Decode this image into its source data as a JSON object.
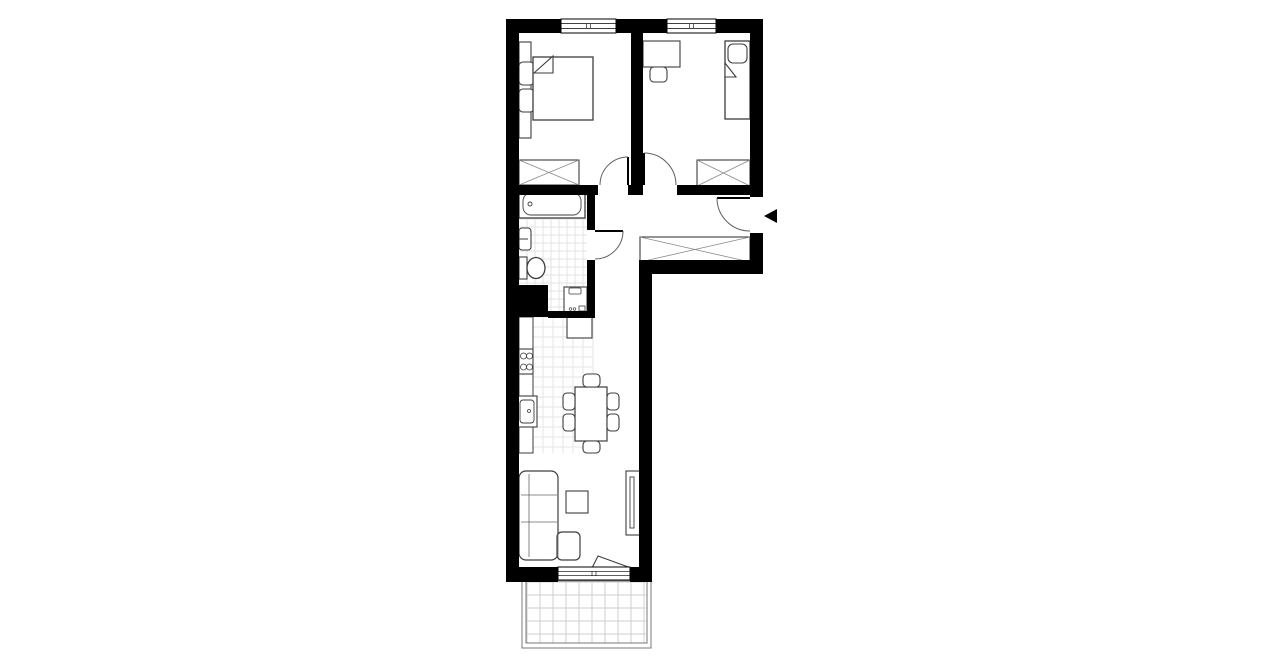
{
  "canvas": {
    "width": 1280,
    "height": 667,
    "background": "#ffffff"
  },
  "colors": {
    "wall": "#000000",
    "line": "#3d3d3d",
    "thin": "#666666",
    "tile_bath": "#e3e3e3",
    "tile_kitchen": "#e6e6e6",
    "tile_balcony": "#cfcfcf",
    "balcony_border": "#7a7a7a",
    "door_arc": "#5f5f5f"
  },
  "plan": {
    "tile_regions": [
      {
        "name": "bathroom-floor-tiles",
        "x": 519,
        "y": 195,
        "w": 68,
        "h": 118,
        "cell": 8,
        "color": "#e3e3e3"
      },
      {
        "name": "kitchen-floor-tiles",
        "x": 533,
        "y": 317,
        "w": 60,
        "h": 136,
        "cell": 10,
        "color": "#e6e6e6"
      },
      {
        "name": "balcony-floor-tiles",
        "x": 527,
        "y": 582,
        "w": 119,
        "h": 61,
        "cell": 13,
        "color": "#cfcfcf"
      }
    ],
    "balcony_border": [
      {
        "name": "balcony-outline-outer",
        "x": 522,
        "y": 581,
        "w": 129,
        "h": 67
      },
      {
        "name": "balcony-outline-inner",
        "x": 526,
        "y": 581,
        "w": 121,
        "h": 62
      }
    ],
    "furniture": [
      {
        "name": "bed1-headboard",
        "t": "rect",
        "x": 519,
        "y": 42,
        "w": 12,
        "h": 96
      },
      {
        "name": "bed1-nightstand-top",
        "t": "rr",
        "x": 519,
        "y": 62,
        "w": 15,
        "h": 23,
        "r": 4
      },
      {
        "name": "bed1-nightstand-bottom",
        "t": "rr",
        "x": 519,
        "y": 89,
        "w": 15,
        "h": 23,
        "r": 4
      },
      {
        "name": "double-bed",
        "t": "rect",
        "x": 533,
        "y": 57,
        "w": 60,
        "h": 63,
        "s": 1.3
      },
      {
        "name": "double-bed-fold",
        "t": "pg",
        "pts": "534,73 553,56 553,73"
      },
      {
        "name": "wardrobe-bedroom1",
        "t": "x",
        "x": 519,
        "y": 160,
        "w": 60,
        "h": 25
      },
      {
        "name": "desk",
        "t": "rect",
        "x": 643,
        "y": 41,
        "w": 37,
        "h": 26
      },
      {
        "name": "desk-chair",
        "t": "rr",
        "x": 650,
        "y": 67,
        "w": 17,
        "h": 15,
        "r": 4
      },
      {
        "name": "single-bed",
        "t": "rect",
        "x": 725,
        "y": 41,
        "w": 25,
        "h": 78,
        "s": 1.3
      },
      {
        "name": "single-bed-pillow",
        "t": "rr",
        "x": 728,
        "y": 44,
        "w": 19,
        "h": 19,
        "r": 5
      },
      {
        "name": "single-bed-fold",
        "t": "pg",
        "pts": "725,63 736,77 725,77"
      },
      {
        "name": "wardrobe-bedroom2",
        "t": "x",
        "x": 697,
        "y": 160,
        "w": 53,
        "h": 26
      },
      {
        "name": "wardrobe-hall",
        "t": "x",
        "x": 640,
        "y": 237,
        "w": 110,
        "h": 25
      },
      {
        "name": "bathtub",
        "t": "rect",
        "x": 519,
        "y": 190,
        "w": 66,
        "h": 28,
        "s": 1.3
      },
      {
        "name": "bathtub-basin",
        "t": "rr",
        "x": 523,
        "y": 193,
        "w": 58,
        "h": 22,
        "r": 8,
        "s": 0.9
      },
      {
        "name": "bathtub-drain",
        "t": "c",
        "cx": 530,
        "cy": 204,
        "r": 2,
        "s": 0.9
      },
      {
        "name": "bathroom-sink",
        "t": "rr",
        "x": 519,
        "y": 228,
        "w": 12,
        "h": 22,
        "r": 3
      },
      {
        "name": "bathroom-sink-faucet",
        "t": "ln",
        "x1": 519,
        "y1": 239,
        "x2": 528,
        "y2": 239,
        "s": 1
      },
      {
        "name": "toilet-tank",
        "t": "rect",
        "x": 519,
        "y": 257,
        "w": 8,
        "h": 22
      },
      {
        "name": "toilet-bowl",
        "t": "el",
        "cx": 536,
        "cy": 268,
        "rx": 9,
        "ry": 10.5,
        "s": 1.3
      },
      {
        "name": "washing-machine",
        "t": "rect",
        "x": 564,
        "y": 287,
        "w": 23,
        "h": 26
      },
      {
        "name": "washing-machine-drawer",
        "t": "rr",
        "x": 569,
        "y": 288,
        "w": 12,
        "h": 6,
        "r": 1,
        "s": 0.8
      },
      {
        "name": "washing-machine-knob1",
        "t": "c",
        "cx": 570.5,
        "cy": 309,
        "r": 1.3,
        "s": 0.7
      },
      {
        "name": "washing-machine-knob2",
        "t": "c",
        "cx": 574.5,
        "cy": 309,
        "r": 1.3,
        "s": 0.7
      },
      {
        "name": "washing-machine-door",
        "t": "rect",
        "x": 579,
        "y": 306,
        "w": 6,
        "h": 5,
        "s": 0.8
      },
      {
        "name": "kitchen-counter",
        "t": "rect",
        "x": 519,
        "y": 317,
        "w": 14,
        "h": 136,
        "s": 1
      },
      {
        "name": "stove",
        "t": "rect",
        "x": 519,
        "y": 349,
        "w": 14,
        "h": 25
      },
      {
        "name": "stove-burner1",
        "t": "c",
        "cx": 523.5,
        "cy": 356,
        "r": 3,
        "s": 0.8
      },
      {
        "name": "stove-burner2",
        "t": "c",
        "cx": 529.5,
        "cy": 356,
        "r": 3,
        "s": 0.8
      },
      {
        "name": "stove-burner3",
        "t": "c",
        "cx": 523.5,
        "cy": 367,
        "r": 3,
        "s": 0.8
      },
      {
        "name": "stove-burner4",
        "t": "c",
        "cx": 529.5,
        "cy": 367,
        "r": 3,
        "s": 0.8
      },
      {
        "name": "kitchen-sink",
        "t": "rect",
        "x": 517,
        "y": 396,
        "w": 20,
        "h": 31
      },
      {
        "name": "kitchen-sink-basin",
        "t": "rr",
        "x": 520,
        "y": 400,
        "w": 14,
        "h": 23,
        "r": 3,
        "s": 0.9
      },
      {
        "name": "kitchen-sink-drain",
        "t": "c",
        "cx": 529,
        "cy": 411,
        "r": 1.5,
        "s": 0.8
      },
      {
        "name": "kitchen-tall-unit",
        "t": "rect",
        "x": 567,
        "y": 317,
        "w": 25,
        "h": 21
      },
      {
        "name": "dining-table",
        "t": "rect",
        "x": 575,
        "y": 387,
        "w": 32,
        "h": 54,
        "s": 1.2
      },
      {
        "name": "dining-chair-top",
        "t": "rr",
        "x": 583,
        "y": 374,
        "w": 17,
        "h": 13,
        "r": 4
      },
      {
        "name": "dining-chair-bottom",
        "t": "rr",
        "x": 583,
        "y": 441,
        "w": 17,
        "h": 12,
        "r": 4
      },
      {
        "name": "dining-chair-left-1",
        "t": "rr",
        "x": 563,
        "y": 393,
        "w": 12,
        "h": 17,
        "r": 4
      },
      {
        "name": "dining-chair-left-2",
        "t": "rr",
        "x": 563,
        "y": 414,
        "w": 12,
        "h": 17,
        "r": 4
      },
      {
        "name": "dining-chair-right-1",
        "t": "rr",
        "x": 607,
        "y": 393,
        "w": 12,
        "h": 17,
        "r": 4
      },
      {
        "name": "dining-chair-right-2",
        "t": "rr",
        "x": 607,
        "y": 414,
        "w": 12,
        "h": 17,
        "r": 4
      },
      {
        "name": "sofa-main",
        "t": "rr",
        "x": 519,
        "y": 471,
        "w": 39,
        "h": 89,
        "r": 7,
        "s": 1.2
      },
      {
        "name": "sofa-chaise",
        "t": "rr",
        "x": 557,
        "y": 532,
        "w": 23,
        "h": 28,
        "r": 5,
        "s": 1.2
      },
      {
        "name": "sofa-backrest-line",
        "t": "ln",
        "x1": 529,
        "y1": 474,
        "x2": 529,
        "y2": 557,
        "s": 0.8,
        "sc": "#666666"
      },
      {
        "name": "sofa-cushion-line-1",
        "t": "ln",
        "x1": 521,
        "y1": 495,
        "x2": 557,
        "y2": 495,
        "s": 0.8,
        "sc": "#666666"
      },
      {
        "name": "sofa-cushion-line-2",
        "t": "ln",
        "x1": 521,
        "y1": 522,
        "x2": 557,
        "y2": 522,
        "s": 0.8,
        "sc": "#666666"
      },
      {
        "name": "sofa-chaise-line",
        "t": "ln",
        "x1": 558,
        "y1": 535,
        "x2": 558,
        "y2": 557,
        "s": 0.8,
        "sc": "#666666"
      },
      {
        "name": "coffee-table",
        "t": "rect",
        "x": 566,
        "y": 491,
        "w": 22,
        "h": 22
      },
      {
        "name": "tv-bench",
        "t": "rect",
        "x": 626,
        "y": 471,
        "w": 14,
        "h": 64
      },
      {
        "name": "tv",
        "t": "rect",
        "x": 630,
        "y": 477,
        "w": 4,
        "h": 51,
        "s": 0.9
      },
      {
        "name": "balcony-door-leaf",
        "t": "pg",
        "pts": "598,556 631,568 592,568"
      }
    ],
    "walls": [
      {
        "name": "wall-top",
        "x": 506,
        "y": 19,
        "w": 257,
        "h": 14
      },
      {
        "name": "wall-left",
        "x": 506,
        "y": 19,
        "w": 13,
        "h": 563
      },
      {
        "name": "wall-right",
        "x": 750,
        "y": 19,
        "w": 13,
        "h": 255
      },
      {
        "name": "wall-corridor-bottom",
        "x": 639,
        "y": 260,
        "w": 124,
        "h": 14
      },
      {
        "name": "wall-column-right",
        "x": 639,
        "y": 260,
        "w": 13,
        "h": 322
      },
      {
        "name": "wall-bottom-left",
        "x": 506,
        "y": 567,
        "w": 52,
        "h": 15
      },
      {
        "name": "wall-bottom-right",
        "x": 630,
        "y": 567,
        "w": 22,
        "h": 15
      },
      {
        "name": "wall-bedroom-divider",
        "x": 631,
        "y": 33,
        "w": 12,
        "h": 162
      },
      {
        "name": "wall-hall-left",
        "x": 519,
        "y": 185,
        "w": 79,
        "h": 10
      },
      {
        "name": "wall-hall-mid",
        "x": 628,
        "y": 185,
        "w": 15,
        "h": 10
      },
      {
        "name": "wall-hall-right",
        "x": 677,
        "y": 185,
        "w": 73,
        "h": 10
      },
      {
        "name": "wall-bathroom-upper",
        "x": 587,
        "y": 195,
        "w": 8,
        "h": 35
      },
      {
        "name": "wall-bathroom-lower",
        "x": 587,
        "y": 260,
        "w": 8,
        "h": 58
      },
      {
        "name": "wall-bathroom-block",
        "x": 506,
        "y": 285,
        "w": 42,
        "h": 32
      },
      {
        "name": "wall-bathroom-bottom",
        "x": 548,
        "y": 311,
        "w": 47,
        "h": 7
      }
    ],
    "gaps": [
      {
        "name": "entrance-opening",
        "x": 750,
        "y": 197,
        "w": 13,
        "h": 36
      }
    ],
    "windows": [
      {
        "name": "window-bedroom1",
        "x": 561,
        "y": 19,
        "w": 55,
        "h": 14
      },
      {
        "name": "window-bedroom2",
        "x": 667,
        "y": 19,
        "w": 49,
        "h": 14
      },
      {
        "name": "balcony-door-window",
        "x": 558,
        "y": 567,
        "w": 72,
        "h": 13
      }
    ],
    "doors": [
      {
        "name": "door-bedroom1",
        "leaf": [
          628,
          185,
          628,
          157
        ],
        "arc": "M 628 157 A 28 28 0 0 0 600 185"
      },
      {
        "name": "door-bedroom2",
        "leaf": [
          644,
          185,
          644,
          153
        ],
        "arc": "M 644 153 A 32 32 0 0 1 676 185"
      },
      {
        "name": "door-bathroom",
        "leaf": [
          595,
          231,
          623,
          231
        ],
        "arc": "M 623 231 A 28 28 0 0 1 595 259"
      },
      {
        "name": "door-entrance",
        "leaf": [
          750,
          198,
          717,
          198
        ],
        "arc": "M 717 198 A 33 33 0 0 0 750 231"
      }
    ],
    "entrance_marker": {
      "points": "764,216 777,209 777,223",
      "color": "#000000"
    }
  }
}
